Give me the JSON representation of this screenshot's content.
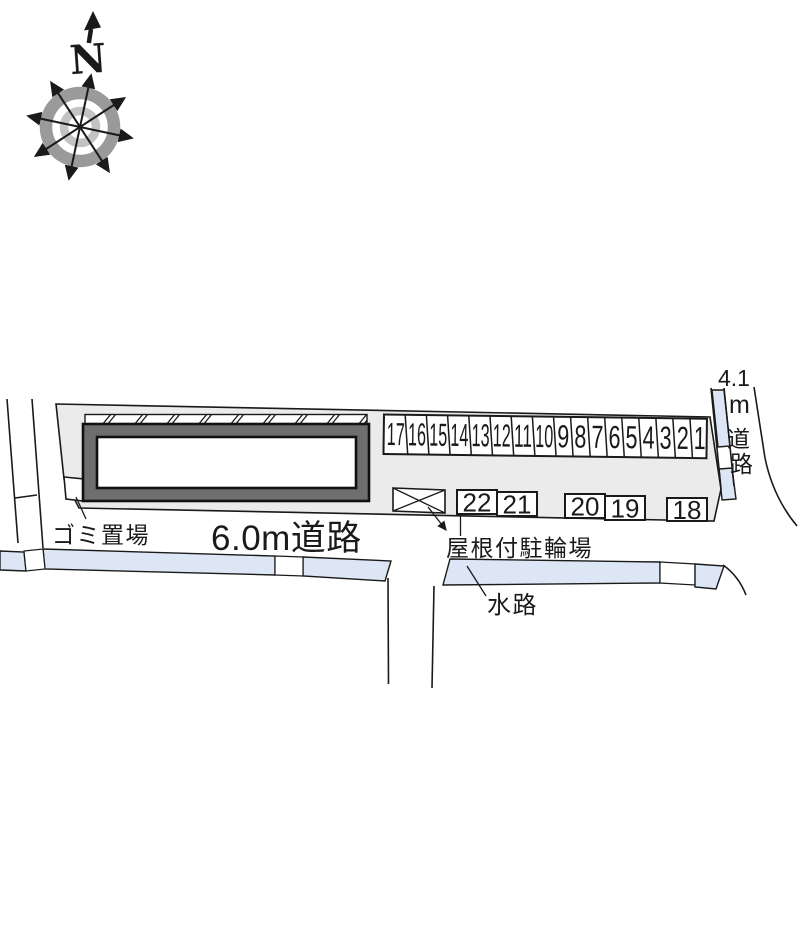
{
  "compass": {
    "north_label": "N"
  },
  "labels": {
    "garbage": "ゴミ置場",
    "road_60": "6.0m道路",
    "bike_shed": "屋根付駐輪場",
    "waterway": "水路",
    "road_41_num": "4.1",
    "road_41_m": "m",
    "road_41_do": "道",
    "road_41_ro": "路"
  },
  "stalls": {
    "row1": [
      "17",
      "16",
      "15",
      "14",
      "13",
      "12",
      "11",
      "10",
      "9",
      "8",
      "7",
      "6",
      "5",
      "4",
      "3",
      "2",
      "1"
    ],
    "row2": [
      "22",
      "21",
      "20",
      "19",
      "18"
    ]
  },
  "colors": {
    "parcel_fill": "#ebebeb",
    "building_band": "#6e6e6e",
    "water_blue": "#dce6f5",
    "line": "#1a1a1a",
    "compass_ring_outer": "#9a9a9a",
    "compass_ring_inner": "#c3c3c3"
  }
}
